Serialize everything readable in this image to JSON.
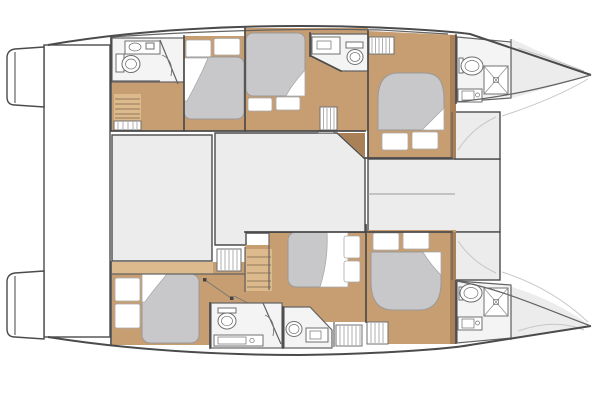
{
  "window": {
    "width": 600,
    "height": 400
  },
  "diagram": {
    "type": "boat-floor-plan",
    "subject": "catamaran-yacht-accommodation-layout",
    "counts": {
      "cabins": 6,
      "double-berths": 6,
      "bathrooms": 6,
      "shower-trays": 2,
      "wardrobes": 5,
      "staircases": 2
    }
  },
  "colors": {
    "background": "#ffffff",
    "outline": "#4b4b4b",
    "wall": "#636363",
    "deck": "#ececec",
    "deck_line": "#c6c6c6",
    "wood": "#c79d72",
    "wood_light": "#dcba8e",
    "wood_dark": "#aa8156",
    "mattress": "#c8c8ca",
    "mattress_edge": "#9a9a9a",
    "room": "#f4f4f4",
    "fixture_edge": "#6f6f6f"
  },
  "areas": {
    "center": [
      "cockpit",
      "salon",
      "foredeck",
      "trampoline",
      "aft-platform"
    ],
    "port_hull": [
      "transom-steps",
      "aft-bathroom",
      "companionway-stairs",
      "aft-cabin",
      "mid-cabin",
      "mid-bathroom",
      "forward-cabin",
      "forepeak-bathroom",
      "bow-deck"
    ],
    "starboard_hull": [
      "transom-steps",
      "aft-cabin",
      "companionway-stairs",
      "aft-bathroom",
      "mid-bathroom",
      "mid-cabin",
      "forward-cabin",
      "forepeak-bathroom",
      "bow-deck"
    ]
  },
  "fixtures": [
    "toilet",
    "sink",
    "vanity-counter",
    "shower-tray",
    "double-berth",
    "pillows",
    "duvet",
    "wardrobe",
    "stairs"
  ]
}
